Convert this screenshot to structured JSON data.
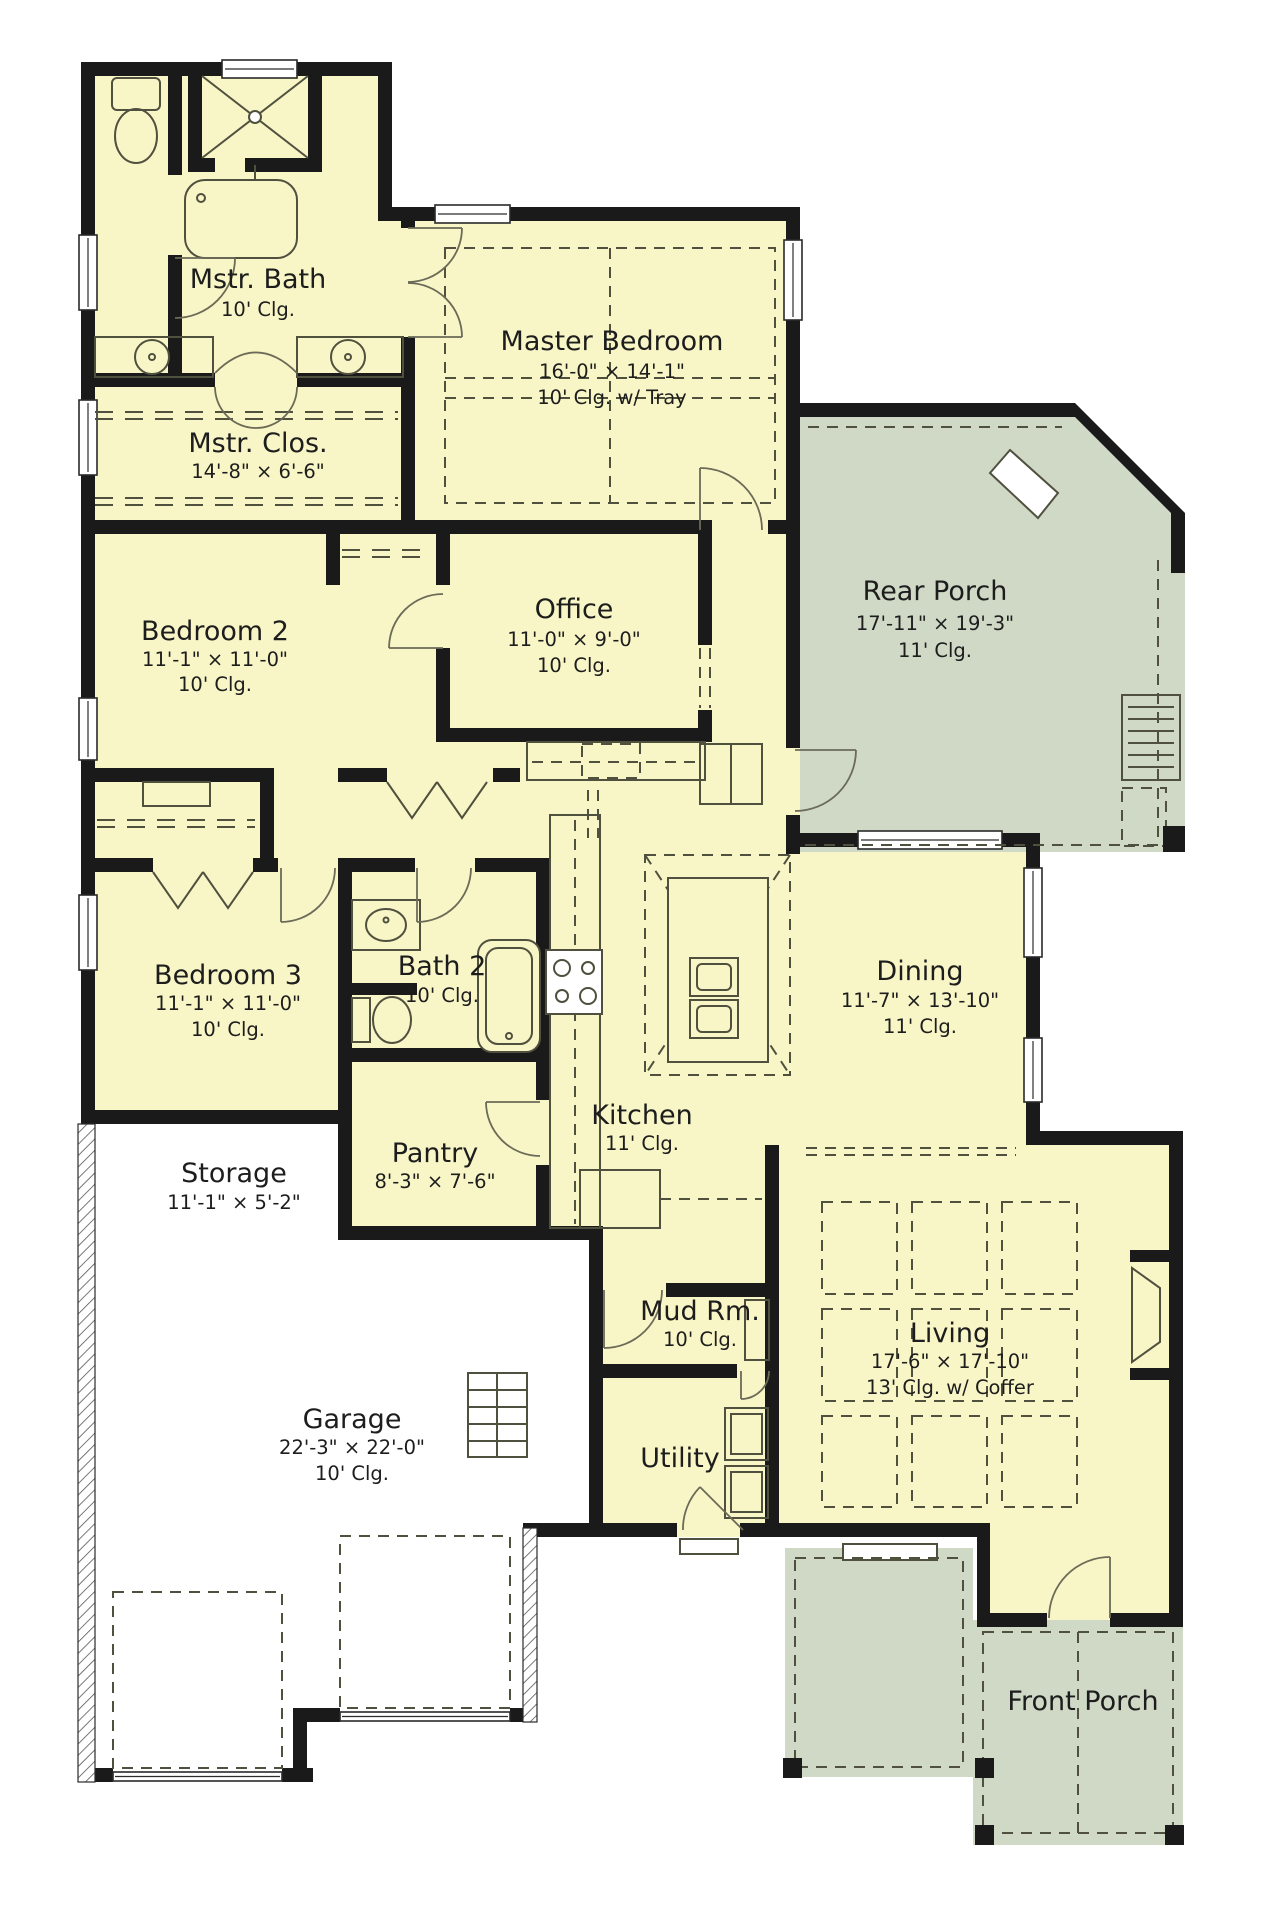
{
  "title": "House Floor Plan",
  "colors": {
    "floor": "#f8f6c6",
    "porch": "#cfd9c6",
    "wall": "#1a1a1a",
    "line": "#50503f",
    "paper": "#ffffff"
  },
  "rooms": {
    "mstr_bath": {
      "name": "Mstr. Bath",
      "ceiling": "10' Clg."
    },
    "master_bedroom": {
      "name": "Master Bedroom",
      "dims": "16'-0\" × 14'-1\"",
      "ceiling": "10' Clg. w/ Tray"
    },
    "mstr_clos": {
      "name": "Mstr. Clos.",
      "dims": "14'-8\" × 6'-6\""
    },
    "bedroom2": {
      "name": "Bedroom 2",
      "dims": "11'-1\" × 11'-0\"",
      "ceiling": "10' Clg."
    },
    "office": {
      "name": "Office",
      "dims": "11'-0\" × 9'-0\"",
      "ceiling": "10' Clg."
    },
    "rear_porch": {
      "name": "Rear Porch",
      "dims": "17'-11\" × 19'-3\"",
      "ceiling": "11' Clg."
    },
    "bedroom3": {
      "name": "Bedroom 3",
      "dims": "11'-1\" × 11'-0\"",
      "ceiling": "10' Clg."
    },
    "bath2": {
      "name": "Bath 2",
      "ceiling": "10' Clg."
    },
    "dining": {
      "name": "Dining",
      "dims": "11'-7\" × 13'-10\"",
      "ceiling": "11' Clg."
    },
    "kitchen": {
      "name": "Kitchen",
      "ceiling": "11' Clg."
    },
    "pantry": {
      "name": "Pantry",
      "dims": "8'-3\" × 7'-6\""
    },
    "storage": {
      "name": "Storage",
      "dims": "11'-1\" × 5'-2\""
    },
    "mud_rm": {
      "name": "Mud Rm.",
      "ceiling": "10' Clg."
    },
    "garage": {
      "name": "Garage",
      "dims": "22'-3\" × 22'-0\"",
      "ceiling": "10' Clg."
    },
    "utility": {
      "name": "Utility"
    },
    "living": {
      "name": "Living",
      "dims": "17'-6\" × 17'-10\"",
      "ceiling": "13' Clg. w/ Coffer"
    },
    "front_porch": {
      "name": "Front Porch"
    }
  }
}
